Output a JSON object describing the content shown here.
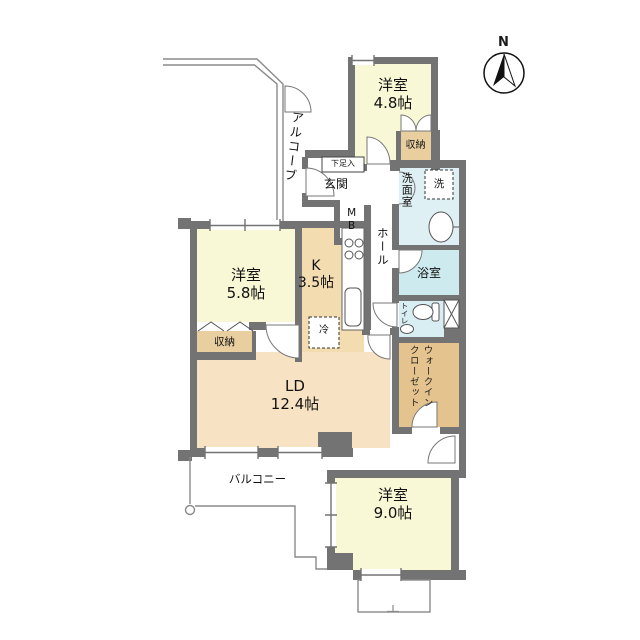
{
  "compass": {
    "north_label": "N"
  },
  "rooms": {
    "bedroom_north": {
      "label": "洋室",
      "size": "4.8帖"
    },
    "bedroom_west": {
      "label": "洋室",
      "size": "5.8帖"
    },
    "bedroom_south": {
      "label": "洋室",
      "size": "9.0帖"
    },
    "kitchen": {
      "label": "K",
      "size": "3.5帖"
    },
    "living_dining": {
      "label": "LD",
      "size": "12.4帖"
    },
    "alcove": {
      "label": "アルコーブ"
    },
    "entrance": {
      "label": "玄関"
    },
    "shoe_cabinet": {
      "label": "下足入"
    },
    "meter_box": {
      "label": "MB"
    },
    "hall": {
      "label": "ホール"
    },
    "washroom": {
      "label": "洗面室"
    },
    "washer": {
      "label": "洗"
    },
    "bathroom": {
      "label": "浴室"
    },
    "toilet": {
      "label": "トイレ"
    },
    "walk_in_closet": {
      "label": "ウォークイン\nクローゼット"
    },
    "closet_north": {
      "label": "収納"
    },
    "closet_west": {
      "label": "収納"
    },
    "refrigerator": {
      "label": "冷"
    },
    "balcony": {
      "label": "バルコニー"
    }
  },
  "colors": {
    "wall": "#737373",
    "bedroom_yellow": "#f9f8d6",
    "kitchen_tan": "#f3dcb0",
    "living_peach": "#f8e2c4",
    "closet_tan": "#e9cfa0",
    "wic_tan": "#e4c38f",
    "washroom_blue": "#dff0f4",
    "bath_blue": "#cdeaef",
    "toilet_blue": "#d9eef3",
    "outline_gray": "#8a8a8a"
  }
}
